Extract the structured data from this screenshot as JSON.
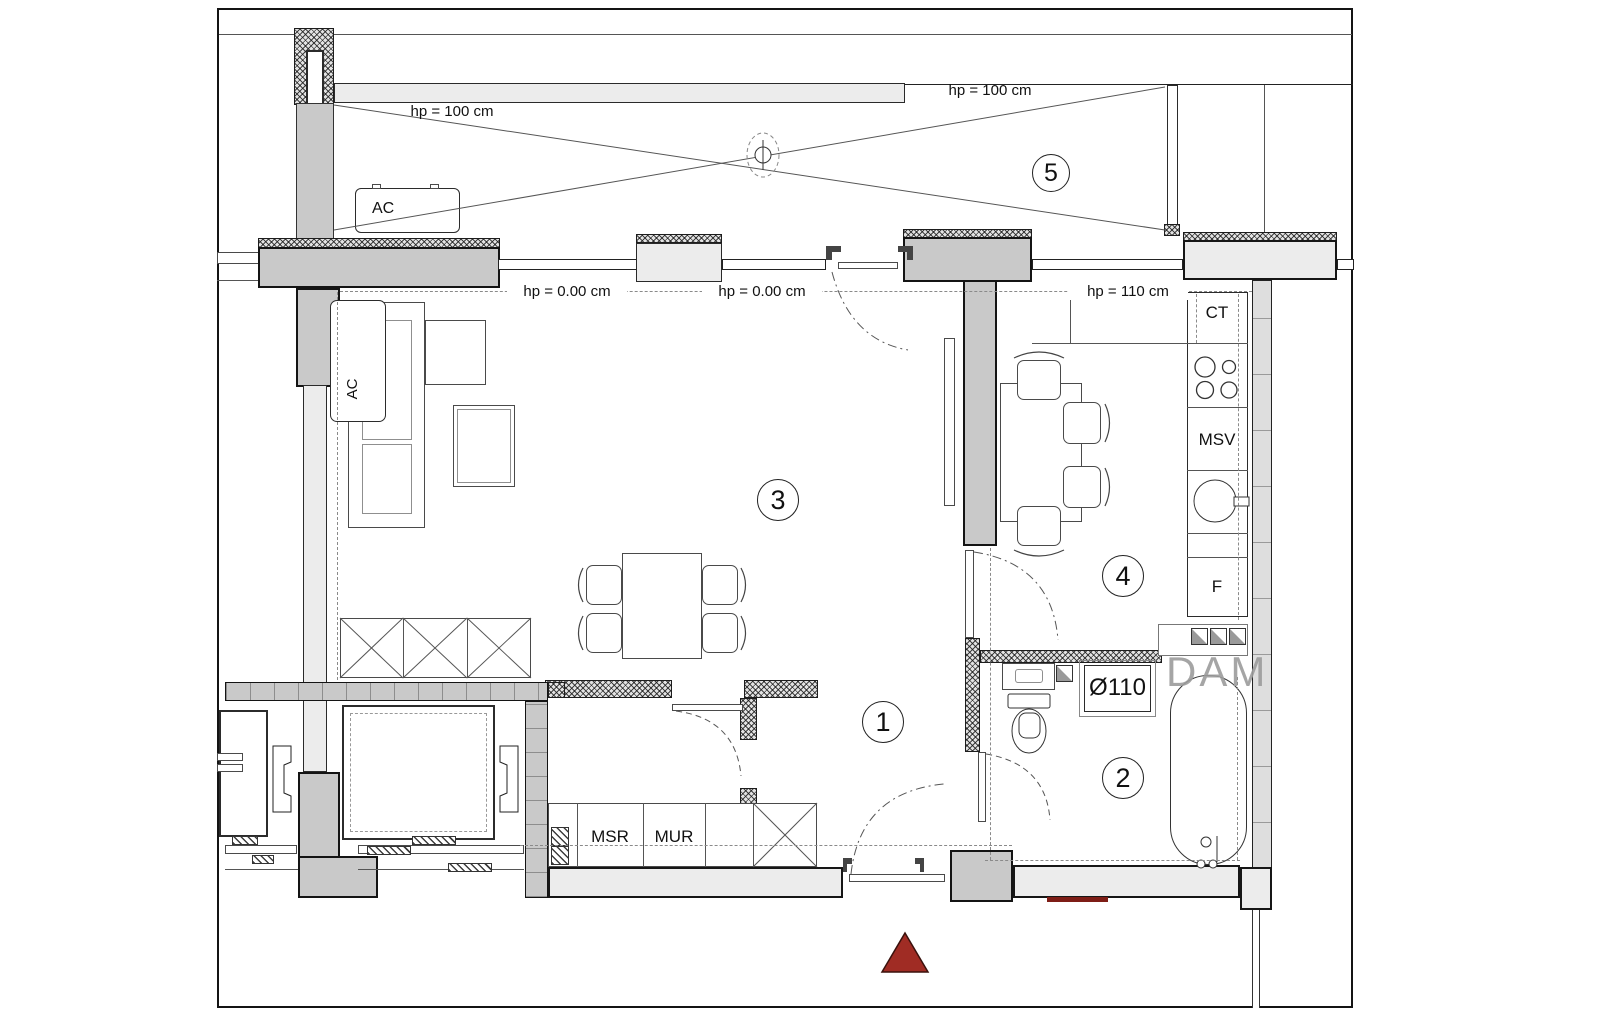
{
  "annotations": {
    "hp_balcony_left": "hp = 100 cm",
    "hp_balcony_right": "hp = 100 cm",
    "hp_living_left": "hp = 0.00 cm",
    "hp_living_right": "hp = 0.00 cm",
    "hp_kitchen": "hp = 110 cm"
  },
  "rooms": {
    "hall": "1",
    "bathroom": "2",
    "living": "3",
    "kitchen": "4",
    "balcony": "5"
  },
  "labels": {
    "ac_balcony": "AC",
    "ac_interior": "AC",
    "countertop": "CT",
    "appliance_msv": "MSV",
    "fridge": "F",
    "cabinet_msr": "MSR",
    "cabinet_mur": "MUR",
    "drain_diameter": "Ø110",
    "watermark": "DAM"
  },
  "colors": {
    "wall_dark": "#c9c9c9",
    "wall_light": "#ececec",
    "marker_red": "#a02c24",
    "line": "#1c1c1c"
  }
}
